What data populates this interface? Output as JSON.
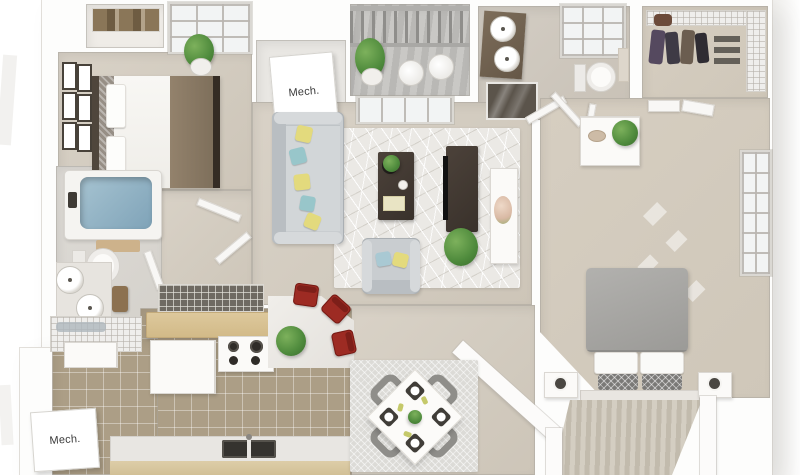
{
  "scene": {
    "type": "3d-rendered-floor-plan",
    "view": "top-down dollhouse",
    "background": "#ffffff",
    "description": "Two-bedroom apartment 3D floor plan render with living room, kitchen, dining area, two bathrooms, balcony, walk-in closet, stairs and two mechanical closets"
  },
  "labels": {
    "mech_top": "Mech.",
    "mech_bottom": "Mech."
  },
  "rooms": [
    {
      "name": "bedroom-1",
      "furniture": [
        "bed with white and brown bedding",
        "dark headboard",
        "gallery wall frames",
        "wire closet shelf with baskets",
        "potted plant",
        "window"
      ]
    },
    {
      "name": "mech-closet-top",
      "furniture": [
        "white mechanical unit labeled Mech."
      ]
    },
    {
      "name": "balcony",
      "furniture": [
        "railing",
        "plank deck",
        "two white chairs",
        "potted plant"
      ]
    },
    {
      "name": "bathroom-2",
      "furniture": [
        "dark vanity with two round sinks",
        "window",
        "toilet",
        "towel",
        "glass shower"
      ]
    },
    {
      "name": "walk-in-closet",
      "furniture": [
        "wire shelving",
        "hanging clothes",
        "purse",
        "shoes"
      ]
    },
    {
      "name": "living-room",
      "furniture": [
        "gray sofa with yellow and teal pillows",
        "geometric area rug",
        "dark coffee table with plants and book",
        "gray armchair with pillows",
        "dark TV console with TV",
        "potted plant"
      ]
    },
    {
      "name": "master-bedroom",
      "furniture": [
        "bed with gray comforter and patterned pillows",
        "two nightstands with lamps",
        "white dresser with plant",
        "closet doors",
        "console table with flowers",
        "window",
        "open entry doors"
      ]
    },
    {
      "name": "bathroom-1",
      "furniture": [
        "bathtub with water",
        "bath mat",
        "toilet",
        "vanity with two round sinks",
        "wood stool",
        "wire linen shelves"
      ]
    },
    {
      "name": "kitchen",
      "furniture": [
        "tan bar counter",
        "wire pantry shelf",
        "refrigerator",
        "range with burners",
        "angled peninsula with plant",
        "three red bar chairs",
        "bottom counter with double sink"
      ]
    },
    {
      "name": "dining-area",
      "furniture": [
        "textured rug",
        "white square table rotated 45 degrees",
        "four dark placemats with white plates",
        "centerpiece plant",
        "four gray chairs"
      ]
    },
    {
      "name": "laundry-mech-closet-bottom",
      "furniture": [
        "washer unit",
        "white mechanical unit labeled Mech."
      ]
    },
    {
      "name": "stairs",
      "furniture": [
        "striped stair treads"
      ]
    }
  ],
  "palette": {
    "wall": "#fcfbfa",
    "carpet": "#d2cbbf",
    "tile": "#ac9e86",
    "bar_counter": "#d9c295",
    "accent_red_chair": "#9d2b23",
    "pillow_yellow": "#e3da7d",
    "pillow_teal": "#98c6ca",
    "tub_water": "#8fb3c5",
    "plant_green": "#4e8a3c",
    "dark_wood": "#42392f",
    "bed2_gray": "#a7a6a3"
  }
}
